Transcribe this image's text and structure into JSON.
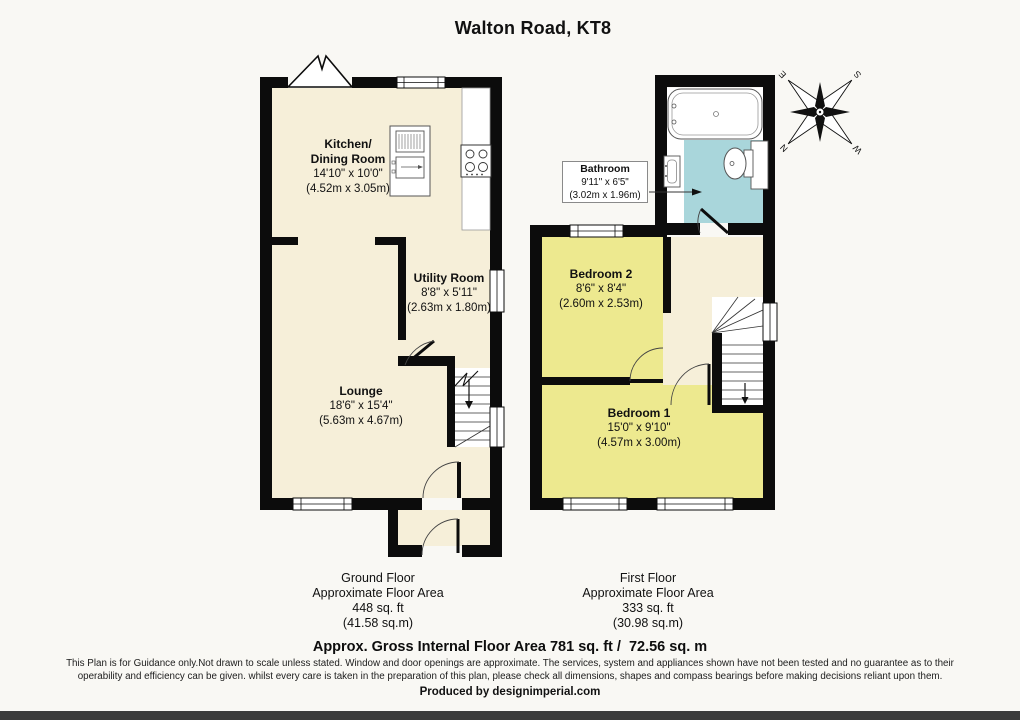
{
  "title": "Walton Road, KT8",
  "rooms": {
    "kitchen": {
      "name": "Kitchen/\nDining Room",
      "imperial": "14'10\" x 10'0\"",
      "metric": "(4.52m x 3.05m)"
    },
    "utility": {
      "name": "Utility Room",
      "imperial": "8'8\" x 5'11\"",
      "metric": "(2.63m x 1.80m)"
    },
    "lounge": {
      "name": "Lounge",
      "imperial": "18'6\" x 15'4\"",
      "metric": "(5.63m x 4.67m)"
    },
    "bathroom": {
      "name": "Bathroom",
      "imperial": "9'11\" x 6'5\"",
      "metric": "(3.02m x 1.96m)"
    },
    "bedroom2": {
      "name": "Bedroom 2",
      "imperial": "8'6\" x 8'4\"",
      "metric": "(2.60m x 2.53m)"
    },
    "bedroom1": {
      "name": "Bedroom 1",
      "imperial": "15'0\" x 9'10\"",
      "metric": "(4.57m x 3.00m)"
    }
  },
  "floors": {
    "ground": {
      "name": "Ground Floor",
      "area_label": "Approximate Floor Area",
      "area_ft": "448 sq. ft",
      "area_m": "(41.58 sq.m)"
    },
    "first": {
      "name": "First Floor",
      "area_label": "Approximate Floor Area",
      "area_ft": "333 sq. ft",
      "area_m": "(30.98 sq.m)"
    }
  },
  "compass": {
    "n": "N",
    "s": "S",
    "e": "E",
    "w": "W"
  },
  "footer": {
    "gross_area": "Approx. Gross Internal Floor Area 781 sq. ft /  72.56 sq. m",
    "disclaimer_line1": "This Plan is for Guidance only.Not drawn to scale unless stated. Window and door openings are approximate. The services, system and appliances shown have not been tested and no guarantee as to their",
    "disclaimer_line2": "operability and efficiency can be given. whilst every care is taken in the preparation of this plan, please check all dimensions, shapes and compass bearings before making decisions reliant upon them.",
    "produced_by": "Produced by designimperial.com"
  },
  "colors": {
    "floor_cream": "#f6efd9",
    "floor_yellow": "#ede98f",
    "floor_blue": "#a9d6db",
    "wall_black": "#0c0c0c",
    "footer_bar": "#3b3b3b"
  }
}
